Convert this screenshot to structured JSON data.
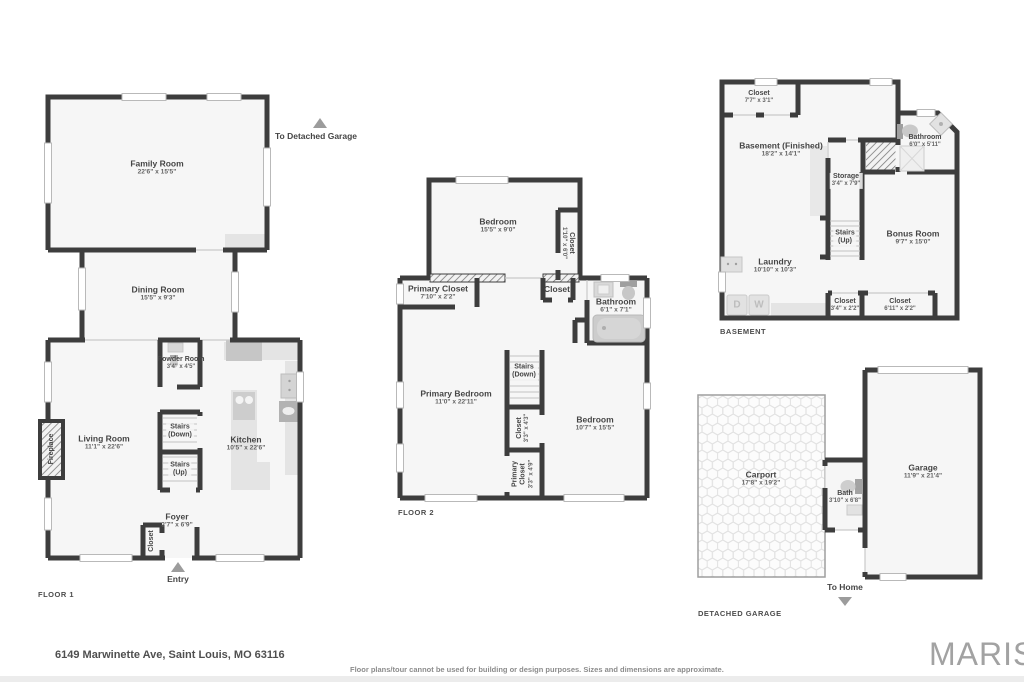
{
  "colors": {
    "wall": "#3d3d3d",
    "floor": "#f6f6f6",
    "arrow": "#9c9c9c",
    "brand_gray": "#a2a2a2"
  },
  "floor1": {
    "label": "FLOOR 1",
    "to_garage": "To Detached Garage",
    "entry": "Entry",
    "rooms": {
      "family": {
        "name": "Family Room",
        "dims": "22'6\" x 15'5\""
      },
      "dining": {
        "name": "Dining Room",
        "dims": "15'5\" x 9'3\""
      },
      "powder": {
        "name": "Powder Room",
        "dims": "3'4\" x 4'5\""
      },
      "living": {
        "name": "Living Room",
        "dims": "11'1\" x 22'6\""
      },
      "kitchen": {
        "name": "Kitchen",
        "dims": "10'5\" x 22'6\""
      },
      "foyer": {
        "name": "Foyer",
        "dims": "3'7\" x 6'9\""
      },
      "stairs_down": {
        "name": "Stairs",
        "sub": "(Down)"
      },
      "stairs_up": {
        "name": "Stairs",
        "sub": "(Up)"
      },
      "fireplace": {
        "name": "Fireplace"
      },
      "closet": {
        "name": "Closet"
      }
    }
  },
  "floor2": {
    "label": "FLOOR 2",
    "rooms": {
      "bedroom_top": {
        "name": "Bedroom",
        "dims": "15'5\" x 9'0\""
      },
      "closet_right": {
        "name": "Closet",
        "dims": "1'10\" x 6'0\""
      },
      "primary_closet": {
        "name": "Primary Closet",
        "dims": "7'10\" x 2'2\""
      },
      "closet_hall": {
        "name": "Closet"
      },
      "bathroom": {
        "name": "Bathroom",
        "dims": "6'1\" x 7'1\""
      },
      "primary_bedroom": {
        "name": "Primary Bedroom",
        "dims": "11'0\" x 22'11\""
      },
      "stairs_down": {
        "name": "Stairs",
        "sub": "(Down)"
      },
      "closet_mid": {
        "name": "Closet",
        "dims": "3'3\" x 4'3\""
      },
      "bedroom_right": {
        "name": "Bedroom",
        "dims": "10'7\" x 15'5\""
      },
      "primary_closet_small": {
        "name": "Primary Closet",
        "dims": "3'3\" x 4'9\""
      }
    }
  },
  "basement": {
    "label": "BASEMENT",
    "rooms": {
      "closet_top": {
        "name": "Closet",
        "dims": "7'7\" x 3'1\""
      },
      "finished": {
        "name": "Basement (Finished)",
        "dims": "18'2\" x 14'1\""
      },
      "storage": {
        "name": "Storage",
        "dims": "3'4\" x 7'9\""
      },
      "bathroom": {
        "name": "Bathroom",
        "dims": "6'0\" x 5'11\""
      },
      "stairs_up": {
        "name": "Stairs",
        "sub": "(Up)"
      },
      "laundry": {
        "name": "Laundry",
        "dims": "10'10\" x 10'3\""
      },
      "bonus": {
        "name": "Bonus Room",
        "dims": "9'7\" x 15'0\""
      },
      "closet_small": {
        "name": "Closet",
        "dims": "3'4\" x 2'2\""
      },
      "closet_long": {
        "name": "Closet",
        "dims": "6'11\" x 2'2\""
      }
    },
    "appliances": {
      "dryer": "D",
      "washer": "W"
    }
  },
  "garage": {
    "label": "DETACHED GARAGE",
    "to_home": "To Home",
    "rooms": {
      "carport": {
        "name": "Carport",
        "dims": "17'8\" x 19'2\""
      },
      "bath": {
        "name": "Bath",
        "dims": "3'10\" x 6'8\""
      },
      "garage": {
        "name": "Garage",
        "dims": "11'9\" x 21'4\""
      }
    }
  },
  "footer": {
    "address": "6149 Marwinette Ave, Saint Louis, MO 63116",
    "disclaimer": "Floor plans/tour cannot be used for building or design purposes. Sizes and dimensions are approximate.",
    "brand": "MARIS"
  }
}
